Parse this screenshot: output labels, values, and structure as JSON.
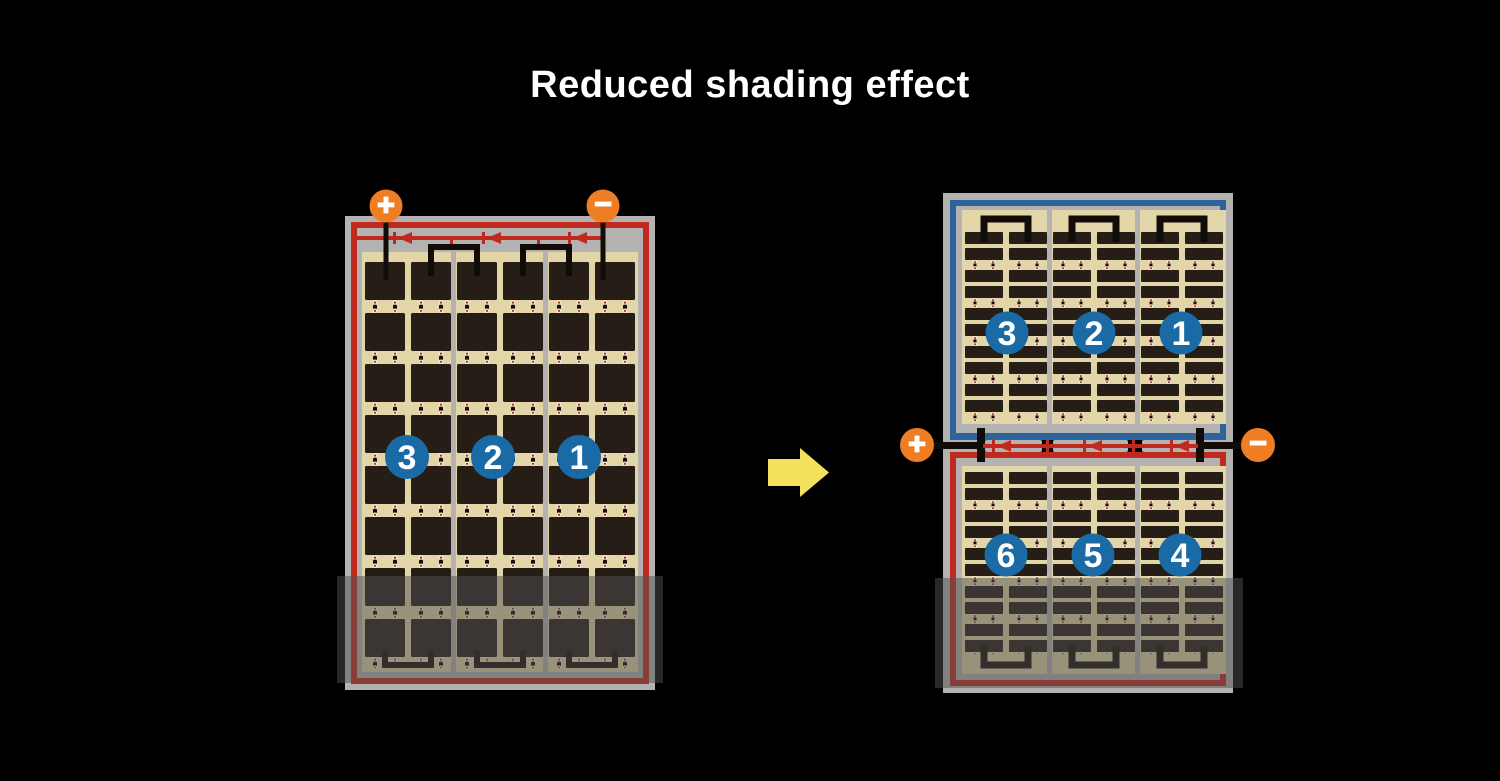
{
  "title": "Reduced shading effect",
  "colors": {
    "background": "#000000",
    "frame_gray": "#b3b2b0",
    "border_red": "#c02a1e",
    "border_blue": "#2e649c",
    "cell_field_tan": "#e2d5a7",
    "cell_dark": "#261d17",
    "number_circle_blue": "#1a6ba5",
    "terminal_orange": "#ee7d23",
    "arrow_yellow": "#f6e15e",
    "wire_black": "#120c08",
    "wire_red": "#c02a1e",
    "shading_overlay": "rgba(80,80,80,0.5)"
  },
  "left_panel": {
    "plus_label": "+",
    "minus_label": "−",
    "string_numbers": [
      "3",
      "2",
      "1"
    ]
  },
  "right_panel": {
    "plus_label": "+",
    "minus_label": "−",
    "top_string_numbers": [
      "3",
      "2",
      "1"
    ],
    "bottom_string_numbers": [
      "6",
      "5",
      "4"
    ]
  }
}
